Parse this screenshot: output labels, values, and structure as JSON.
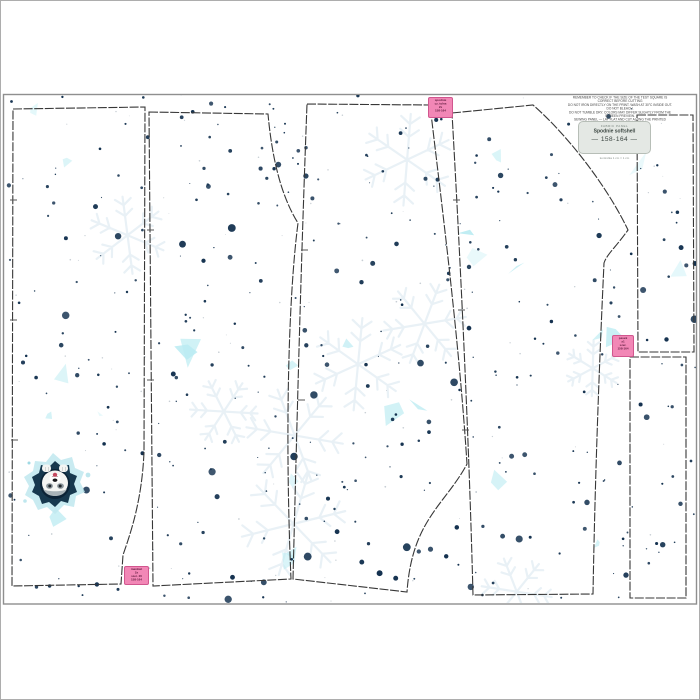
{
  "page": {
    "background": "#ffffff",
    "frame_color": "#8f8f8f"
  },
  "fabric": {
    "pattern": {
      "seed": 11,
      "dot_color": "#12304e",
      "dot_count": 380,
      "micro_dot_color": "#b9c2c9",
      "micro_dot_count": 80,
      "shard_colors": [
        "#c6eff4",
        "#baebf2",
        "#d7f4f8"
      ],
      "shard_count": 26,
      "snowflake_color": "#e9f1f6",
      "snowflake_count": 9
    }
  },
  "disclaimer": {
    "lines": [
      "REMEMBER TO CHECK IF THE SIZE OF THE TEST SQUARE IS CORRECT BEFORE CUTTING",
      "DO NOT IRON DIRECTLY ON THE PRINT. WASH AT 30°C INSIDE OUT. DO NOT BLEACH.",
      "DO NOT TUMBLE DRY. COLORS MAY DIFFER SLIGHTLY FROM THE SCREEN PREVIEW.",
      "SEWING PANEL — LAY FLAT AND CUT ALONG THE PRINTED OUTLINES."
    ]
  },
  "size_label": {
    "brand": "FABRIC PANEL",
    "product": "Spodnie softshell",
    "size": "— 158-164 —",
    "note": "kontrolka 1 cm = 1 cm"
  },
  "piece_labels": [
    {
      "id": "top",
      "lines": [
        "spodnie",
        "cz. tylna",
        "2x",
        "158-164"
      ]
    },
    {
      "id": "right",
      "lines": [
        "pasek",
        "x1",
        "szer.",
        "158-164"
      ]
    },
    {
      "id": "bottom",
      "lines": [
        "mankiet",
        "2x",
        "szer. 20",
        "158-164"
      ]
    }
  ],
  "print": {
    "husky_tongue": "#c4495f",
    "husky_hole": "#16384e",
    "husky_splash": "#bfe7ee"
  }
}
